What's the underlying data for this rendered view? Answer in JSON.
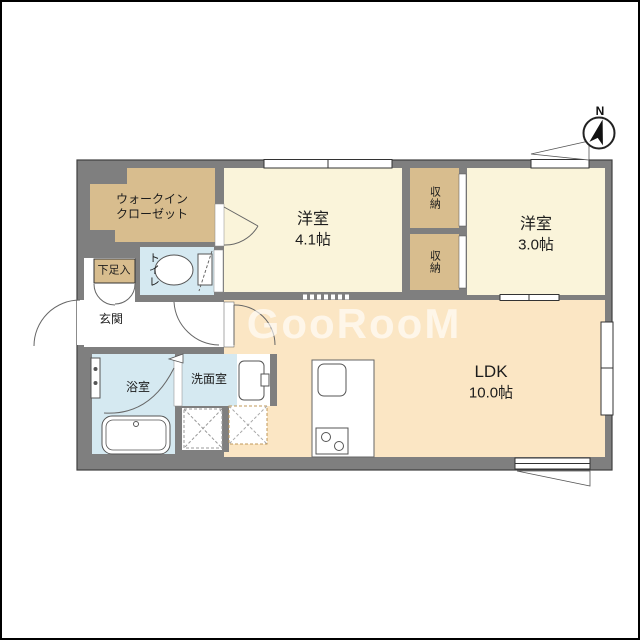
{
  "page": {
    "type": "floorplan",
    "title": "1LDK apartment floor plan"
  },
  "compass": {
    "label": "N"
  },
  "watermark": {
    "text": "GooRooM"
  },
  "rooms": {
    "walk_in_closet": {
      "label_line1": "ウォークイン",
      "label_line2": "クローゼット"
    },
    "bedroom1": {
      "name": "洋室",
      "size": "4.1帖"
    },
    "storage_top": {
      "label": "収納"
    },
    "storage_bottom": {
      "label": "収納"
    },
    "bedroom2": {
      "name": "洋室",
      "size": "3.0帖"
    },
    "shoe_cabinet": {
      "label": "下足入"
    },
    "entrance": {
      "label": "玄関"
    },
    "toilet": {
      "label": "トイレ"
    },
    "bathroom": {
      "label": "浴室"
    },
    "washroom": {
      "label": "洗面室"
    },
    "ldk": {
      "name": "LDK",
      "size": "10.0帖"
    }
  },
  "colors": {
    "wall": "#7f7f7f",
    "wall_outline": "#3f3f3f",
    "room_cream": "#faf4da",
    "closet_tan": "#d8bd8e",
    "wet_area_blue": "#d5e9f1",
    "ldk_peach": "#fbe6c4",
    "fixture_stroke": "#555555",
    "appliance_dash_tan": "#c09858"
  }
}
